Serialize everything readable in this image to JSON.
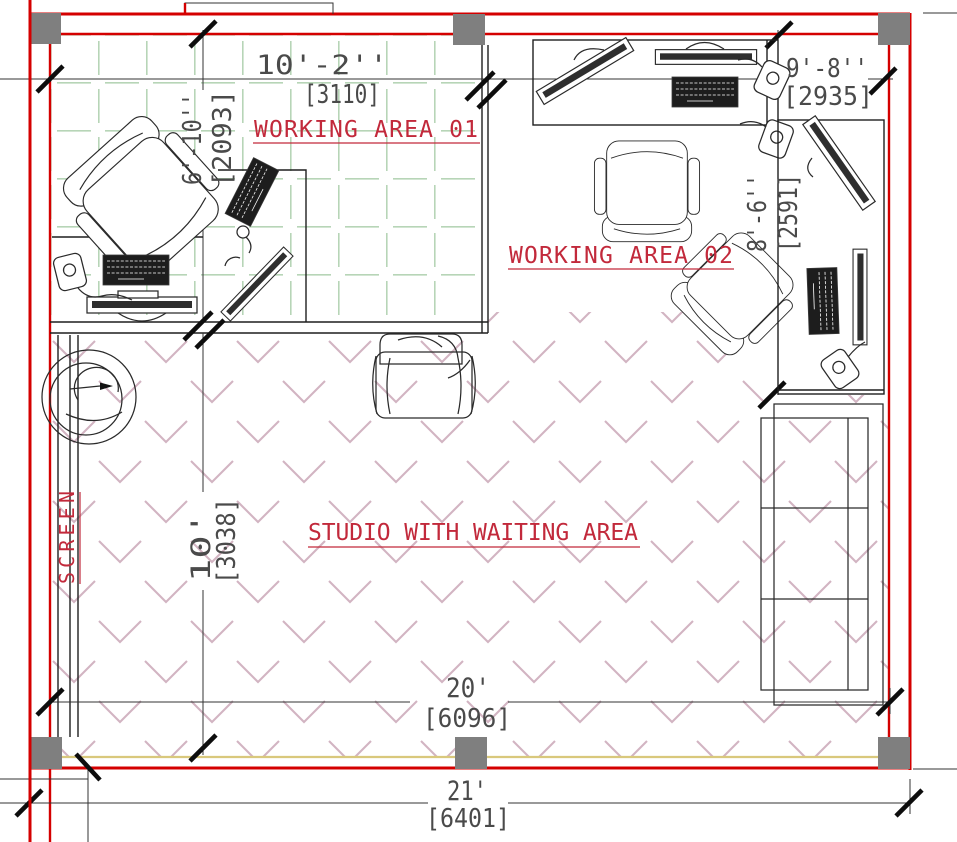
{
  "areas": {
    "working_area_01": {
      "label": "WORKING AREA 01"
    },
    "working_area_02": {
      "label": "WORKING AREA 02"
    },
    "studio": {
      "label": "STUDIO WITH WAITING AREA"
    },
    "screen": {
      "label": "SCREEN"
    }
  },
  "dimensions": {
    "top_left_width": {
      "imperial": "10'-2''",
      "metric": "[3110]"
    },
    "top_right_width": {
      "imperial": "9'-8''",
      "metric": "[2935]"
    },
    "left_height": {
      "imperial": "6'-10''",
      "metric": "[2093]"
    },
    "right_height": {
      "imperial": "8'-6''",
      "metric": "[2591]"
    },
    "studio_height": {
      "imperial": "10'",
      "metric": "[3038]"
    },
    "bottom_width": {
      "imperial": "20'",
      "metric": "[6096]"
    },
    "overall_width": {
      "imperial": "21'",
      "metric": "[6401]"
    }
  },
  "colors": {
    "wall": "#d40000",
    "column": "#7f7f7f",
    "area_label": "#c2293b",
    "dimension_text": "#4a4a4a",
    "hatch_grid": "#b7d5b7",
    "hatch_chevron": "#d2b4c2",
    "window": "#d9c87c",
    "line": "#1f1f1f"
  },
  "furniture": [
    "office-chair",
    "desk",
    "keyboard",
    "monitor",
    "mouse",
    "sofa",
    "armchair",
    "spiral-rug",
    "screen-partition"
  ]
}
